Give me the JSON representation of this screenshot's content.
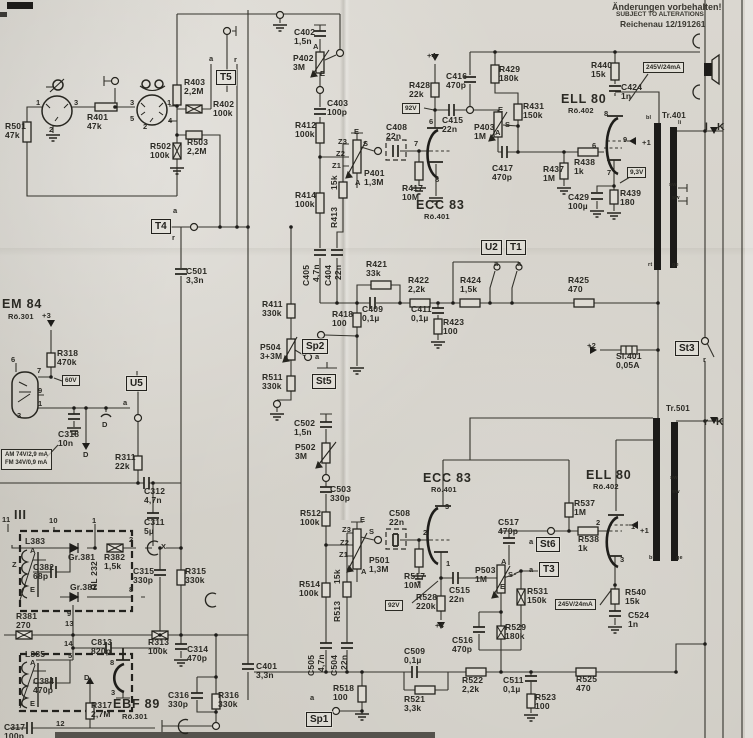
{
  "colors": {
    "paper": "#d8d5ce",
    "ink": "#2b2a24",
    "bar": "#1c1b19"
  },
  "note": {
    "line1": "Änderungen  vorbehalten!",
    "line2": "SUBJECT  TO  ALTERATIONS!",
    "line3": "Reichenau 12/191261"
  },
  "info_box": {
    "x": 1,
    "y": 449,
    "line1": "AM 74V/2,9 mA",
    "line2": "FM 34V/0,9 mA"
  },
  "terminal_boxes": [
    {
      "t": "T5",
      "x": 216,
      "y": 70
    },
    {
      "t": "T4",
      "x": 151,
      "y": 219
    },
    {
      "t": "U5",
      "x": 126,
      "y": 376
    },
    {
      "t": "U2",
      "x": 481,
      "y": 240
    },
    {
      "t": "T1",
      "x": 506,
      "y": 240
    },
    {
      "t": "Sp2",
      "x": 302,
      "y": 339
    },
    {
      "t": "St5",
      "x": 312,
      "y": 374
    },
    {
      "t": "St3",
      "x": 675,
      "y": 341
    },
    {
      "t": "St6",
      "x": 536,
      "y": 537
    },
    {
      "t": "T3",
      "x": 539,
      "y": 562
    },
    {
      "t": "Sp1",
      "x": 306,
      "y": 712
    }
  ],
  "voltage_badges": [
    {
      "t": "92V",
      "x": 402,
      "y": 103
    },
    {
      "t": "60V",
      "x": 62,
      "y": 375
    },
    {
      "t": "9,3V",
      "x": 627,
      "y": 167
    },
    {
      "t": "245V/24mA",
      "x": 643,
      "y": 62
    },
    {
      "t": "245V/24mA",
      "x": 555,
      "y": 599
    },
    {
      "t": "92V",
      "x": 385,
      "y": 600
    }
  ],
  "labels": [
    {
      "t": "R501\n47k",
      "x": 5,
      "y": 122
    },
    {
      "t": "R401\n47k",
      "x": 87,
      "y": 113
    },
    {
      "t": "R403\n2,2M",
      "x": 184,
      "y": 78
    },
    {
      "t": "R402\n100k",
      "x": 213,
      "y": 100
    },
    {
      "t": "R502\n100k",
      "x": 150,
      "y": 142
    },
    {
      "t": "R503\n2,2M",
      "x": 187,
      "y": 138
    },
    {
      "t": "C402\n1,5n",
      "x": 294,
      "y": 28
    },
    {
      "t": "P402\n3M",
      "x": 293,
      "y": 54
    },
    {
      "t": "C403\n100p",
      "x": 327,
      "y": 99
    },
    {
      "t": "R412\n100k",
      "x": 295,
      "y": 121
    },
    {
      "t": "C408\n22n",
      "x": 386,
      "y": 123
    },
    {
      "t": "P401\n1,3M",
      "x": 364,
      "y": 169
    },
    {
      "t": "R417\n10M",
      "x": 402,
      "y": 184
    },
    {
      "t": "ECC 83",
      "x": 416,
      "y": 199,
      "k": "tube"
    },
    {
      "t": "Rö.401",
      "x": 424,
      "y": 213,
      "k": "sub"
    },
    {
      "t": "R428\n22k",
      "x": 409,
      "y": 81
    },
    {
      "t": "C415\n22n",
      "x": 442,
      "y": 116
    },
    {
      "t": "C416\n470p",
      "x": 446,
      "y": 72
    },
    {
      "t": "P403\n1M",
      "x": 474,
      "y": 123
    },
    {
      "t": "R429\n180k",
      "x": 499,
      "y": 65
    },
    {
      "t": "R431\n150k",
      "x": 523,
      "y": 102
    },
    {
      "t": "C417\n470p",
      "x": 492,
      "y": 164
    },
    {
      "t": "R437\n1M",
      "x": 543,
      "y": 165
    },
    {
      "t": "R438\n1k",
      "x": 574,
      "y": 158
    },
    {
      "t": "ELL 80",
      "x": 561,
      "y": 93,
      "k": "tube"
    },
    {
      "t": "Rö.402",
      "x": 568,
      "y": 107,
      "k": "sub"
    },
    {
      "t": "R440\n15k",
      "x": 591,
      "y": 61
    },
    {
      "t": "C424\n1n",
      "x": 621,
      "y": 83
    },
    {
      "t": "Tr.401",
      "x": 662,
      "y": 112,
      "k": "sub2"
    },
    {
      "t": "R439\n180",
      "x": 620,
      "y": 189
    },
    {
      "t": "C429\n100µ",
      "x": 568,
      "y": 193
    },
    {
      "t": "C501\n3,3n",
      "x": 186,
      "y": 267
    },
    {
      "t": "R414\n100k",
      "x": 295,
      "y": 191
    },
    {
      "t": "R421\n33k",
      "x": 366,
      "y": 260
    },
    {
      "t": "R422\n2,2k",
      "x": 408,
      "y": 276
    },
    {
      "t": "R424\n1,5k",
      "x": 460,
      "y": 276
    },
    {
      "t": "R425\n470",
      "x": 568,
      "y": 276
    },
    {
      "t": "C409\n0,1µ",
      "x": 362,
      "y": 305
    },
    {
      "t": "C411\n0,1µ",
      "x": 411,
      "y": 305
    },
    {
      "t": "R423\n100",
      "x": 443,
      "y": 318
    },
    {
      "t": "R418\n100",
      "x": 332,
      "y": 310
    },
    {
      "t": "R411\n330k",
      "x": 262,
      "y": 300
    },
    {
      "t": "P504\n3+3M",
      "x": 260,
      "y": 343
    },
    {
      "t": "R511\n330k",
      "x": 262,
      "y": 373
    },
    {
      "t": "C502\n1,5n",
      "x": 294,
      "y": 419
    },
    {
      "t": "P502\n3M",
      "x": 295,
      "y": 443
    },
    {
      "t": "C503\n330p",
      "x": 330,
      "y": 485
    },
    {
      "t": "ECC 83",
      "x": 423,
      "y": 472,
      "k": "tube"
    },
    {
      "t": "Rö.401",
      "x": 431,
      "y": 486,
      "k": "sub"
    },
    {
      "t": "Si.401\n0,05A",
      "x": 616,
      "y": 352
    },
    {
      "t": "R512\n100k",
      "x": 300,
      "y": 509
    },
    {
      "t": "C508\n22n",
      "x": 389,
      "y": 509
    },
    {
      "t": "P501\n1,3M",
      "x": 369,
      "y": 556
    },
    {
      "t": "R517\n10M",
      "x": 404,
      "y": 572
    },
    {
      "t": "R528\n220k",
      "x": 416,
      "y": 593
    },
    {
      "t": "C515\n22n",
      "x": 449,
      "y": 586
    },
    {
      "t": "C516\n470p",
      "x": 452,
      "y": 636
    },
    {
      "t": "P503\n1M",
      "x": 475,
      "y": 566
    },
    {
      "t": "R514\n100k",
      "x": 299,
      "y": 580
    },
    {
      "t": "C401\n3,3n",
      "x": 256,
      "y": 662
    },
    {
      "t": "R518\n100",
      "x": 333,
      "y": 684
    },
    {
      "t": "C509\n0,1µ",
      "x": 404,
      "y": 647
    },
    {
      "t": "R521\n3,3k",
      "x": 404,
      "y": 695
    },
    {
      "t": "R522\n2,2k",
      "x": 462,
      "y": 676
    },
    {
      "t": "C511\n0,1µ",
      "x": 503,
      "y": 676
    },
    {
      "t": "R523\n100",
      "x": 535,
      "y": 693
    },
    {
      "t": "R525\n470",
      "x": 576,
      "y": 675
    },
    {
      "t": "R537\n1M",
      "x": 574,
      "y": 499
    },
    {
      "t": "C517\n470p",
      "x": 498,
      "y": 518
    },
    {
      "t": "R538\n1k",
      "x": 578,
      "y": 535
    },
    {
      "t": "R531\n150k",
      "x": 527,
      "y": 587
    },
    {
      "t": "R529\n180k",
      "x": 505,
      "y": 623
    },
    {
      "t": "R540\n15k",
      "x": 625,
      "y": 588
    },
    {
      "t": "C524\n1n",
      "x": 628,
      "y": 611
    },
    {
      "t": "ELL 80",
      "x": 586,
      "y": 469,
      "k": "tube"
    },
    {
      "t": "Rö.402",
      "x": 593,
      "y": 483,
      "k": "sub"
    },
    {
      "t": "Tr.501",
      "x": 666,
      "y": 405,
      "k": "sub2"
    },
    {
      "t": "EM 84",
      "x": 2,
      "y": 298,
      "k": "tube"
    },
    {
      "t": "Rö.301",
      "x": 8,
      "y": 313,
      "k": "sub"
    },
    {
      "t": "R318\n470k",
      "x": 57,
      "y": 349
    },
    {
      "t": "C318\n10n",
      "x": 58,
      "y": 430
    },
    {
      "t": "R311\n22k",
      "x": 115,
      "y": 453
    },
    {
      "t": "C312\n4,7n",
      "x": 144,
      "y": 487
    },
    {
      "t": "C311\n5µ",
      "x": 144,
      "y": 518
    },
    {
      "t": "III",
      "x": 14,
      "y": 509,
      "k": "tube"
    },
    {
      "t": "L383",
      "x": 25,
      "y": 537
    },
    {
      "t": "C382\n68p",
      "x": 33,
      "y": 563
    },
    {
      "t": "Gr.381",
      "x": 68,
      "y": 553
    },
    {
      "t": "R382\n1,5k",
      "x": 104,
      "y": 553
    },
    {
      "t": "Gr.382",
      "x": 70,
      "y": 583
    },
    {
      "t": "C315\n330p",
      "x": 133,
      "y": 567
    },
    {
      "t": "R315\n330k",
      "x": 185,
      "y": 567
    },
    {
      "t": "R381\n270",
      "x": 16,
      "y": 612
    },
    {
      "t": "C813\n820p",
      "x": 91,
      "y": 638
    },
    {
      "t": "R313\n100k",
      "x": 148,
      "y": 638
    },
    {
      "t": "C314\n470p",
      "x": 187,
      "y": 645
    },
    {
      "t": "L385",
      "x": 25,
      "y": 650
    },
    {
      "t": "C384\n470p",
      "x": 33,
      "y": 677
    },
    {
      "t": "R317\n2,7M",
      "x": 91,
      "y": 701
    },
    {
      "t": "EBF 89",
      "x": 113,
      "y": 698,
      "k": "tube"
    },
    {
      "t": "Rö.301",
      "x": 122,
      "y": 713,
      "k": "sub"
    },
    {
      "t": "C316\n330p",
      "x": 168,
      "y": 691
    },
    {
      "t": "R316\n330k",
      "x": 218,
      "y": 691
    },
    {
      "t": "C317\n100p",
      "x": 4,
      "y": 723
    },
    {
      "t": "C405",
      "x": 302,
      "y": 286,
      "r": 1
    },
    {
      "t": "4,7n",
      "x": 312,
      "y": 282,
      "r": 1
    },
    {
      "t": "C404",
      "x": 324,
      "y": 286,
      "r": 1
    },
    {
      "t": "22n",
      "x": 334,
      "y": 280,
      "r": 1
    },
    {
      "t": "15k",
      "x": 330,
      "y": 190,
      "r": 1
    },
    {
      "t": "R413",
      "x": 330,
      "y": 228,
      "r": 1
    },
    {
      "t": "C505",
      "x": 307,
      "y": 676,
      "r": 1
    },
    {
      "t": "4,7n",
      "x": 317,
      "y": 672,
      "r": 1
    },
    {
      "t": "C504",
      "x": 330,
      "y": 676,
      "r": 1
    },
    {
      "t": "22n",
      "x": 340,
      "y": 670,
      "r": 1
    },
    {
      "t": "15k",
      "x": 333,
      "y": 584,
      "r": 1
    },
    {
      "t": "R513",
      "x": 333,
      "y": 622,
      "r": 1
    },
    {
      "t": "RL 232",
      "x": 90,
      "y": 590,
      "r": 1
    },
    {
      "t": "1",
      "x": 36,
      "y": 99,
      "k": "pin"
    },
    {
      "t": "3",
      "x": 74,
      "y": 99,
      "k": "pin"
    },
    {
      "t": "2",
      "x": 49,
      "y": 126,
      "k": "pin"
    },
    {
      "t": "3",
      "x": 130,
      "y": 99,
      "k": "pin"
    },
    {
      "t": "1",
      "x": 167,
      "y": 99,
      "k": "pin"
    },
    {
      "t": "5",
      "x": 130,
      "y": 115,
      "k": "pin"
    },
    {
      "t": "4",
      "x": 168,
      "y": 117,
      "k": "pin"
    },
    {
      "t": "2",
      "x": 143,
      "y": 123,
      "k": "pin"
    },
    {
      "t": "a",
      "x": 209,
      "y": 55,
      "k": "pin"
    },
    {
      "t": "r",
      "x": 234,
      "y": 56,
      "k": "pin"
    },
    {
      "t": "a",
      "x": 173,
      "y": 207,
      "k": "pin"
    },
    {
      "t": "r",
      "x": 172,
      "y": 234,
      "k": "pin"
    },
    {
      "t": "A",
      "x": 313,
      "y": 43,
      "k": "pin"
    },
    {
      "t": "E",
      "x": 320,
      "y": 70,
      "k": "pin"
    },
    {
      "t": "E",
      "x": 354,
      "y": 128,
      "k": "pin"
    },
    {
      "t": "Z3",
      "x": 338,
      "y": 138,
      "k": "pin"
    },
    {
      "t": "S",
      "x": 363,
      "y": 140,
      "k": "pin"
    },
    {
      "t": "Z2",
      "x": 336,
      "y": 150,
      "k": "pin"
    },
    {
      "t": "Z1",
      "x": 332,
      "y": 162,
      "k": "pin"
    },
    {
      "t": "A",
      "x": 355,
      "y": 179,
      "k": "pin"
    },
    {
      "t": "6",
      "x": 429,
      "y": 118,
      "k": "pin"
    },
    {
      "t": "7",
      "x": 414,
      "y": 140,
      "k": "pin"
    },
    {
      "t": "8",
      "x": 435,
      "y": 176,
      "k": "pin"
    },
    {
      "t": "+4",
      "x": 427,
      "y": 52,
      "k": "pin"
    },
    {
      "t": "E",
      "x": 498,
      "y": 106,
      "k": "pin"
    },
    {
      "t": "S",
      "x": 505,
      "y": 121,
      "k": "pin"
    },
    {
      "t": "A",
      "x": 495,
      "y": 129,
      "k": "pin"
    },
    {
      "t": "8",
      "x": 604,
      "y": 110,
      "k": "pin"
    },
    {
      "t": "6",
      "x": 592,
      "y": 142,
      "k": "pin"
    },
    {
      "t": "9",
      "x": 623,
      "y": 136,
      "k": "pin"
    },
    {
      "t": "+1",
      "x": 642,
      "y": 139,
      "k": "pin"
    },
    {
      "t": "7",
      "x": 607,
      "y": 169,
      "k": "pin"
    },
    {
      "t": "bl",
      "x": 646,
      "y": 115,
      "k": "tiny"
    },
    {
      "t": "li",
      "x": 678,
      "y": 120,
      "k": "tiny"
    },
    {
      "t": "rt",
      "x": 648,
      "y": 262,
      "k": "tiny"
    },
    {
      "t": "ge",
      "x": 672,
      "y": 262,
      "k": "tiny"
    },
    {
      "t": "sw",
      "x": 669,
      "y": 182,
      "k": "tiny"
    },
    {
      "t": "sw",
      "x": 672,
      "y": 195,
      "k": "tiny"
    },
    {
      "t": "l",
      "x": 705,
      "y": 122,
      "k": "lk"
    },
    {
      "t": "K",
      "x": 717,
      "y": 122,
      "k": "lk"
    },
    {
      "t": "6",
      "x": 11,
      "y": 356,
      "k": "pin"
    },
    {
      "t": "7",
      "x": 37,
      "y": 367,
      "k": "pin"
    },
    {
      "t": "9",
      "x": 38,
      "y": 387,
      "k": "pin"
    },
    {
      "t": "1",
      "x": 38,
      "y": 400,
      "k": "pin"
    },
    {
      "t": "3",
      "x": 17,
      "y": 412,
      "k": "pin"
    },
    {
      "t": "+3",
      "x": 42,
      "y": 312,
      "k": "pin"
    },
    {
      "t": "a",
      "x": 123,
      "y": 399,
      "k": "pin"
    },
    {
      "t": "D",
      "x": 102,
      "y": 421,
      "k": "pin"
    },
    {
      "t": "D",
      "x": 83,
      "y": 451,
      "k": "pin"
    },
    {
      "t": "D",
      "x": 84,
      "y": 674,
      "k": "pin"
    },
    {
      "t": "X",
      "x": 161,
      "y": 543,
      "k": "pin"
    },
    {
      "t": "a",
      "x": 494,
      "y": 260,
      "k": "pin"
    },
    {
      "t": "a",
      "x": 517,
      "y": 260,
      "k": "pin"
    },
    {
      "t": "a",
      "x": 315,
      "y": 353,
      "k": "pin"
    },
    {
      "t": "11",
      "x": 2,
      "y": 516,
      "k": "pin"
    },
    {
      "t": "10",
      "x": 49,
      "y": 517,
      "k": "pin"
    },
    {
      "t": "1",
      "x": 92,
      "y": 517,
      "k": "pin"
    },
    {
      "t": "2",
      "x": 129,
      "y": 536,
      "k": "pin"
    },
    {
      "t": "8",
      "x": 129,
      "y": 586,
      "k": "pin"
    },
    {
      "t": "9",
      "x": 67,
      "y": 610,
      "k": "pin"
    },
    {
      "t": "13",
      "x": 65,
      "y": 620,
      "k": "pin"
    },
    {
      "t": "14",
      "x": 64,
      "y": 640,
      "k": "pin"
    },
    {
      "t": "5",
      "x": 68,
      "y": 652,
      "k": "pin"
    },
    {
      "t": "12",
      "x": 56,
      "y": 720,
      "k": "pin"
    },
    {
      "t": "A",
      "x": 30,
      "y": 547,
      "k": "pin"
    },
    {
      "t": "Z",
      "x": 12,
      "y": 561,
      "k": "pin"
    },
    {
      "t": "E",
      "x": 30,
      "y": 586,
      "k": "pin"
    },
    {
      "t": "A",
      "x": 30,
      "y": 659,
      "k": "pin"
    },
    {
      "t": "E",
      "x": 30,
      "y": 700,
      "k": "pin"
    },
    {
      "t": "8",
      "x": 110,
      "y": 659,
      "k": "pin"
    },
    {
      "t": "3",
      "x": 111,
      "y": 689,
      "k": "pin"
    },
    {
      "t": "3",
      "x": 445,
      "y": 503,
      "k": "pin"
    },
    {
      "t": "2",
      "x": 423,
      "y": 529,
      "k": "pin"
    },
    {
      "t": "1",
      "x": 446,
      "y": 560,
      "k": "pin"
    },
    {
      "t": "+4",
      "x": 435,
      "y": 622,
      "k": "pin"
    },
    {
      "t": "E",
      "x": 360,
      "y": 516,
      "k": "pin"
    },
    {
      "t": "Z3",
      "x": 342,
      "y": 526,
      "k": "pin"
    },
    {
      "t": "S",
      "x": 369,
      "y": 528,
      "k": "pin"
    },
    {
      "t": "Z2",
      "x": 340,
      "y": 539,
      "k": "pin"
    },
    {
      "t": "Z1",
      "x": 339,
      "y": 551,
      "k": "pin"
    },
    {
      "t": "A",
      "x": 361,
      "y": 568,
      "k": "pin"
    },
    {
      "t": "A",
      "x": 501,
      "y": 558,
      "k": "pin"
    },
    {
      "t": "S",
      "x": 508,
      "y": 571,
      "k": "pin"
    },
    {
      "t": "E",
      "x": 500,
      "y": 583,
      "k": "pin"
    },
    {
      "t": "+2",
      "x": 587,
      "y": 342,
      "k": "pin"
    },
    {
      "t": "2",
      "x": 596,
      "y": 519,
      "k": "pin"
    },
    {
      "t": "1",
      "x": 631,
      "y": 523,
      "k": "pin"
    },
    {
      "t": "+1",
      "x": 640,
      "y": 527,
      "k": "pin"
    },
    {
      "t": "3",
      "x": 620,
      "y": 556,
      "k": "pin"
    },
    {
      "t": "bl",
      "x": 649,
      "y": 555,
      "k": "tiny"
    },
    {
      "t": "ge",
      "x": 676,
      "y": 555,
      "k": "tiny"
    },
    {
      "t": "sw",
      "x": 670,
      "y": 475,
      "k": "tiny"
    },
    {
      "t": "sw",
      "x": 672,
      "y": 489,
      "k": "tiny"
    },
    {
      "t": "r",
      "x": 704,
      "y": 417,
      "k": "lk"
    },
    {
      "t": "K",
      "x": 716,
      "y": 417,
      "k": "lk"
    },
    {
      "t": "r",
      "x": 703,
      "y": 356,
      "k": "pin"
    },
    {
      "t": "a",
      "x": 529,
      "y": 538,
      "k": "pin"
    },
    {
      "t": "a",
      "x": 529,
      "y": 566,
      "k": "pin"
    },
    {
      "t": "a",
      "x": 310,
      "y": 694,
      "k": "pin"
    }
  ]
}
